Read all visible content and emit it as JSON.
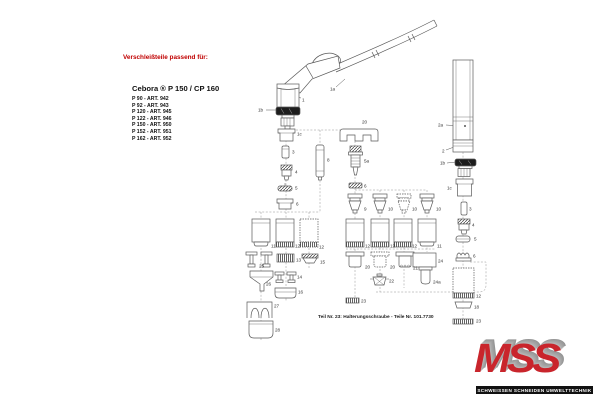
{
  "page": {
    "header": "Verschleißteile passend für:",
    "model": "Cebora ® P 150 / CP 160"
  },
  "articles": [
    "P 90 - ART. 942",
    "P 92 - ART. 943",
    "P 120 - ART. 945",
    "P 122 - ART. 946",
    "P 150 - ART. 950",
    "P 152 - ART. 951",
    "P 162 - ART. 952"
  ],
  "footnote": "Teil Nr. 23: Halterungsschraube - Teile Nr. 101.7730",
  "logo": {
    "name": "MSS",
    "tagline": "SCHWEISSEN SCHNEIDEN UMWELTTECHNIK"
  },
  "colors": {
    "accent_red": "#c00000",
    "logo_red": "#c9252c",
    "logo_shadow_gray": "#9c9c9c",
    "banner_black": "#111111",
    "line_gray": "#5a5a5a"
  },
  "diagram": {
    "part_labels": [
      {
        "n": "1a",
        "x": 330,
        "y": 89
      },
      {
        "n": "1",
        "x": 302,
        "y": 100
      },
      {
        "n": "1b",
        "x": 258,
        "y": 110
      },
      {
        "n": "1c",
        "x": 297,
        "y": 134
      },
      {
        "n": "3",
        "x": 292,
        "y": 152
      },
      {
        "n": "4",
        "x": 295,
        "y": 172
      },
      {
        "n": "5",
        "x": 295,
        "y": 188
      },
      {
        "n": "6",
        "x": 296,
        "y": 204
      },
      {
        "n": "8",
        "x": 327,
        "y": 160
      },
      {
        "n": "20",
        "x": 362,
        "y": 122
      },
      {
        "n": "5a",
        "x": 364,
        "y": 161
      },
      {
        "n": "6",
        "x": 364,
        "y": 186
      },
      {
        "n": "9",
        "x": 364,
        "y": 209
      },
      {
        "n": "10",
        "x": 388,
        "y": 209
      },
      {
        "n": "10",
        "x": 412,
        "y": 209
      },
      {
        "n": "10",
        "x": 436,
        "y": 209
      },
      {
        "n": "12",
        "x": 365,
        "y": 246
      },
      {
        "n": "12",
        "x": 390,
        "y": 246
      },
      {
        "n": "12",
        "x": 412,
        "y": 246
      },
      {
        "n": "11",
        "x": 437,
        "y": 246
      },
      {
        "n": "20",
        "x": 365,
        "y": 267
      },
      {
        "n": "20",
        "x": 390,
        "y": 267
      },
      {
        "n": "21",
        "x": 413,
        "y": 268
      },
      {
        "n": "24",
        "x": 438,
        "y": 261
      },
      {
        "n": "24a",
        "x": 433,
        "y": 282
      },
      {
        "n": "22",
        "x": 389,
        "y": 281
      },
      {
        "n": "23",
        "x": 361,
        "y": 301
      },
      {
        "n": "11",
        "x": 271,
        "y": 246
      },
      {
        "n": "12",
        "x": 295,
        "y": 246
      },
      {
        "n": "12",
        "x": 319,
        "y": 247
      },
      {
        "n": "25",
        "x": 259,
        "y": 266
      },
      {
        "n": "13",
        "x": 296,
        "y": 260
      },
      {
        "n": "15",
        "x": 320,
        "y": 262
      },
      {
        "n": "26",
        "x": 266,
        "y": 284
      },
      {
        "n": "14",
        "x": 297,
        "y": 277
      },
      {
        "n": "16",
        "x": 298,
        "y": 292
      },
      {
        "n": "27",
        "x": 274,
        "y": 306
      },
      {
        "n": "28",
        "x": 275,
        "y": 330
      },
      {
        "n": "2a",
        "x": 438,
        "y": 125
      },
      {
        "n": "2",
        "x": 442,
        "y": 151
      },
      {
        "n": "1b",
        "x": 440,
        "y": 163
      },
      {
        "n": "1c",
        "x": 447,
        "y": 188
      },
      {
        "n": "3",
        "x": 469,
        "y": 209
      },
      {
        "n": "4",
        "x": 472,
        "y": 225
      },
      {
        "n": "5",
        "x": 474,
        "y": 239
      },
      {
        "n": "6",
        "x": 473,
        "y": 256
      },
      {
        "n": "12",
        "x": 476,
        "y": 296
      },
      {
        "n": "18",
        "x": 474,
        "y": 307
      },
      {
        "n": "23",
        "x": 476,
        "y": 321
      }
    ]
  }
}
